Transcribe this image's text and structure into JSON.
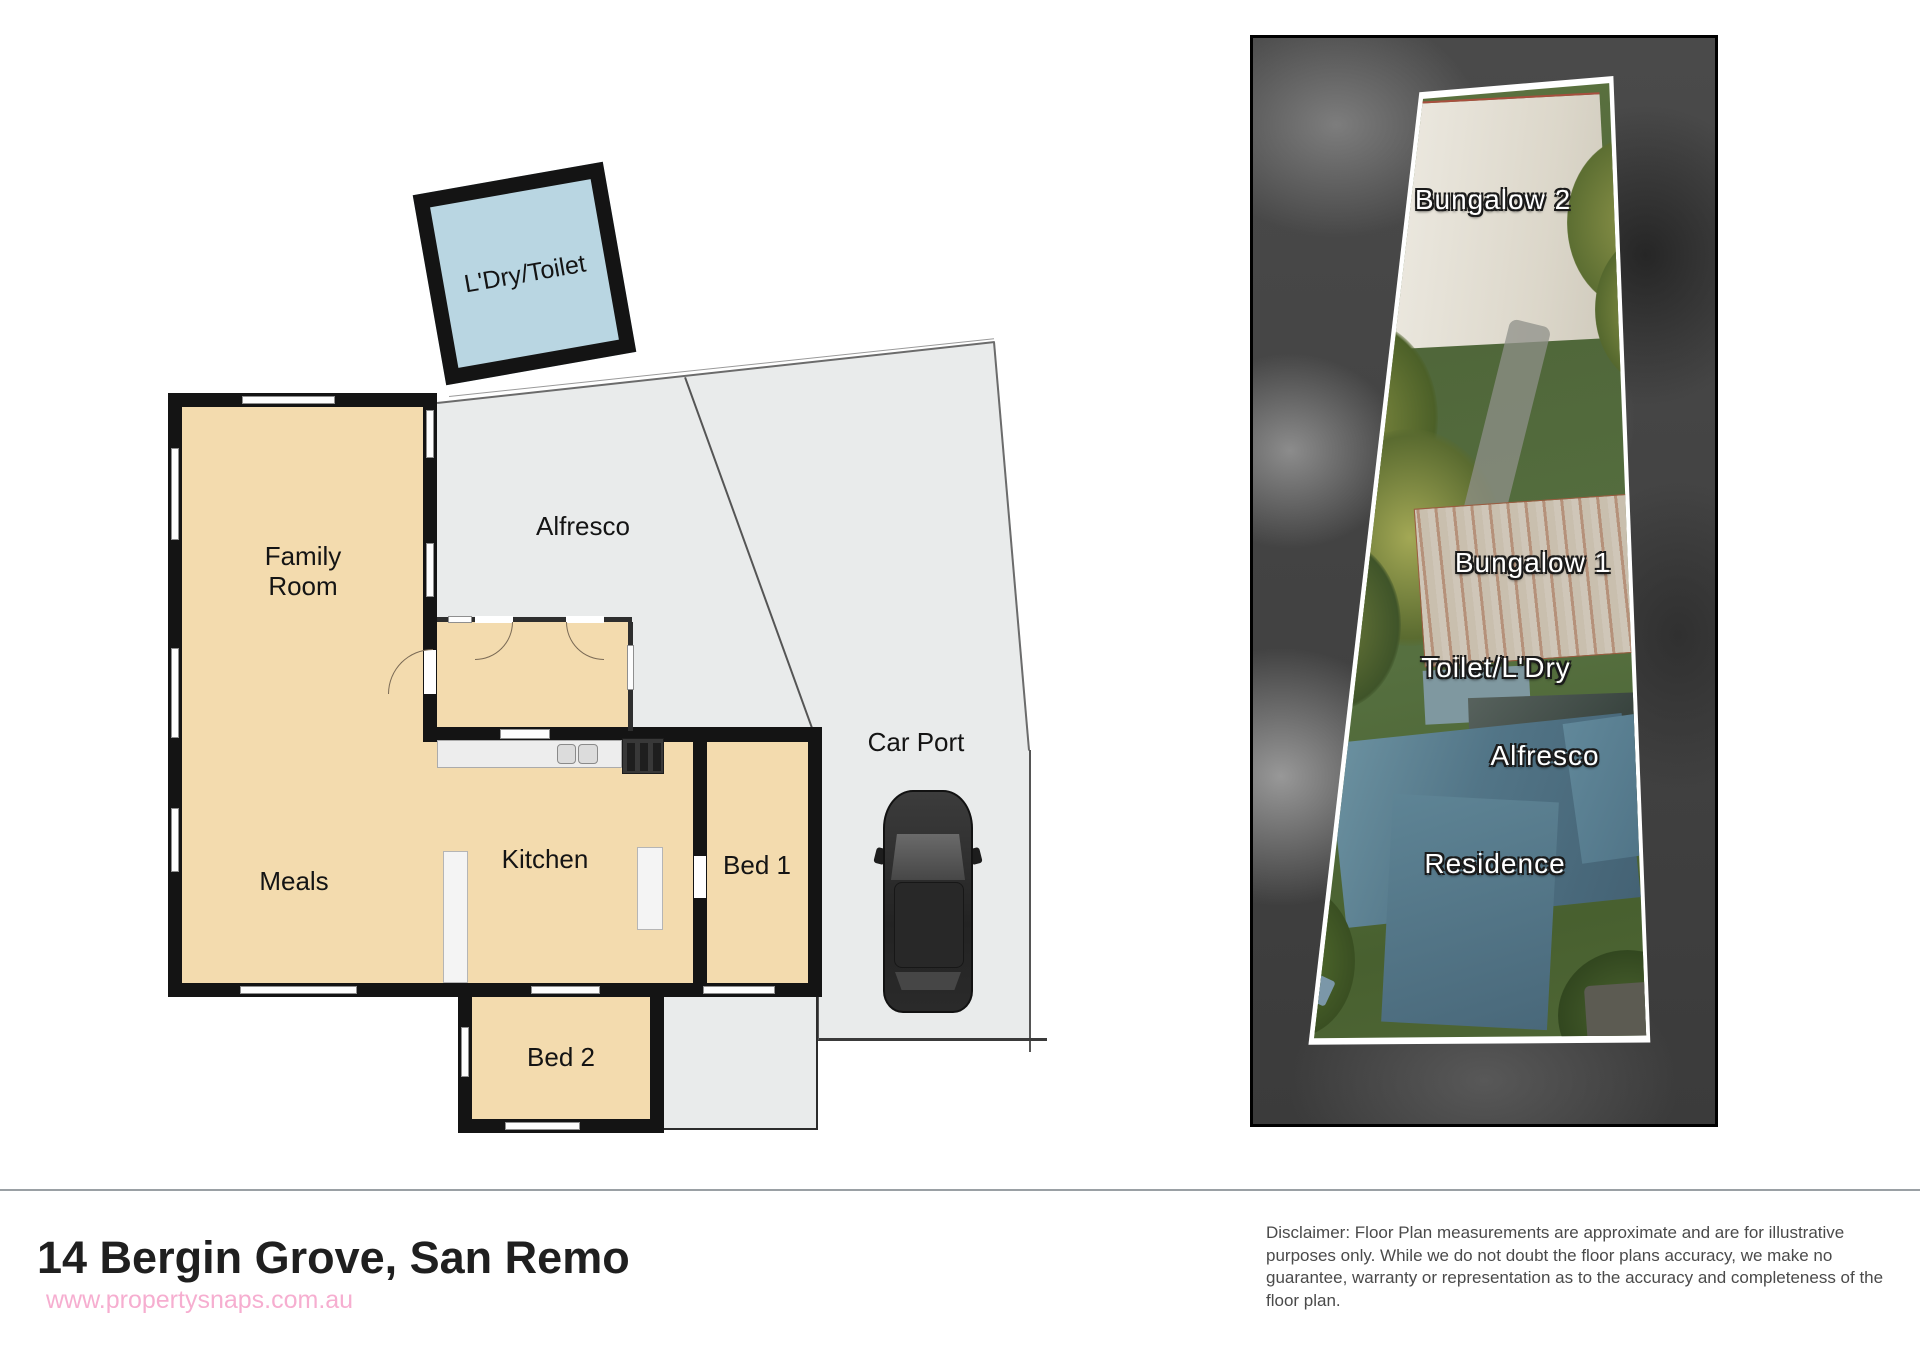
{
  "floor_plan": {
    "labels": {
      "ldry": "L'Dry/Toilet",
      "family_line1": "Family",
      "family_line2": "Room",
      "alfresco": "Alfresco",
      "meals": "Meals",
      "kitchen": "Kitchen",
      "bed1": "Bed 1",
      "bed2": "Bed 2",
      "carport": "Car Port"
    }
  },
  "aerial": {
    "labels": {
      "bungalow2": "Bungalow 2",
      "bungalow1": "Bungalow 1",
      "toilet_ldry": "Toilet/L'Dry",
      "alfresco": "Alfresco",
      "residence": "Residence"
    }
  },
  "footer": {
    "title": "14 Bergin Grove, San Remo",
    "watermark": "www.propertysnaps.com.au",
    "disclaimer": "Disclaimer: Floor Plan measurements are approximate and are for illustrative purposes only. While we do not doubt the floor plans accuracy, we make no guarantee, warranty or representation as to the accuracy and completeness of the floor plan."
  },
  "colors": {
    "tan": "#f3dbae",
    "paving": "#e9ebeb",
    "wall": "#141414",
    "water": "#b9d6e2",
    "pink": "#f6aed0",
    "title": "#1f1f1f",
    "disclaimer": "#4a4a4a"
  }
}
